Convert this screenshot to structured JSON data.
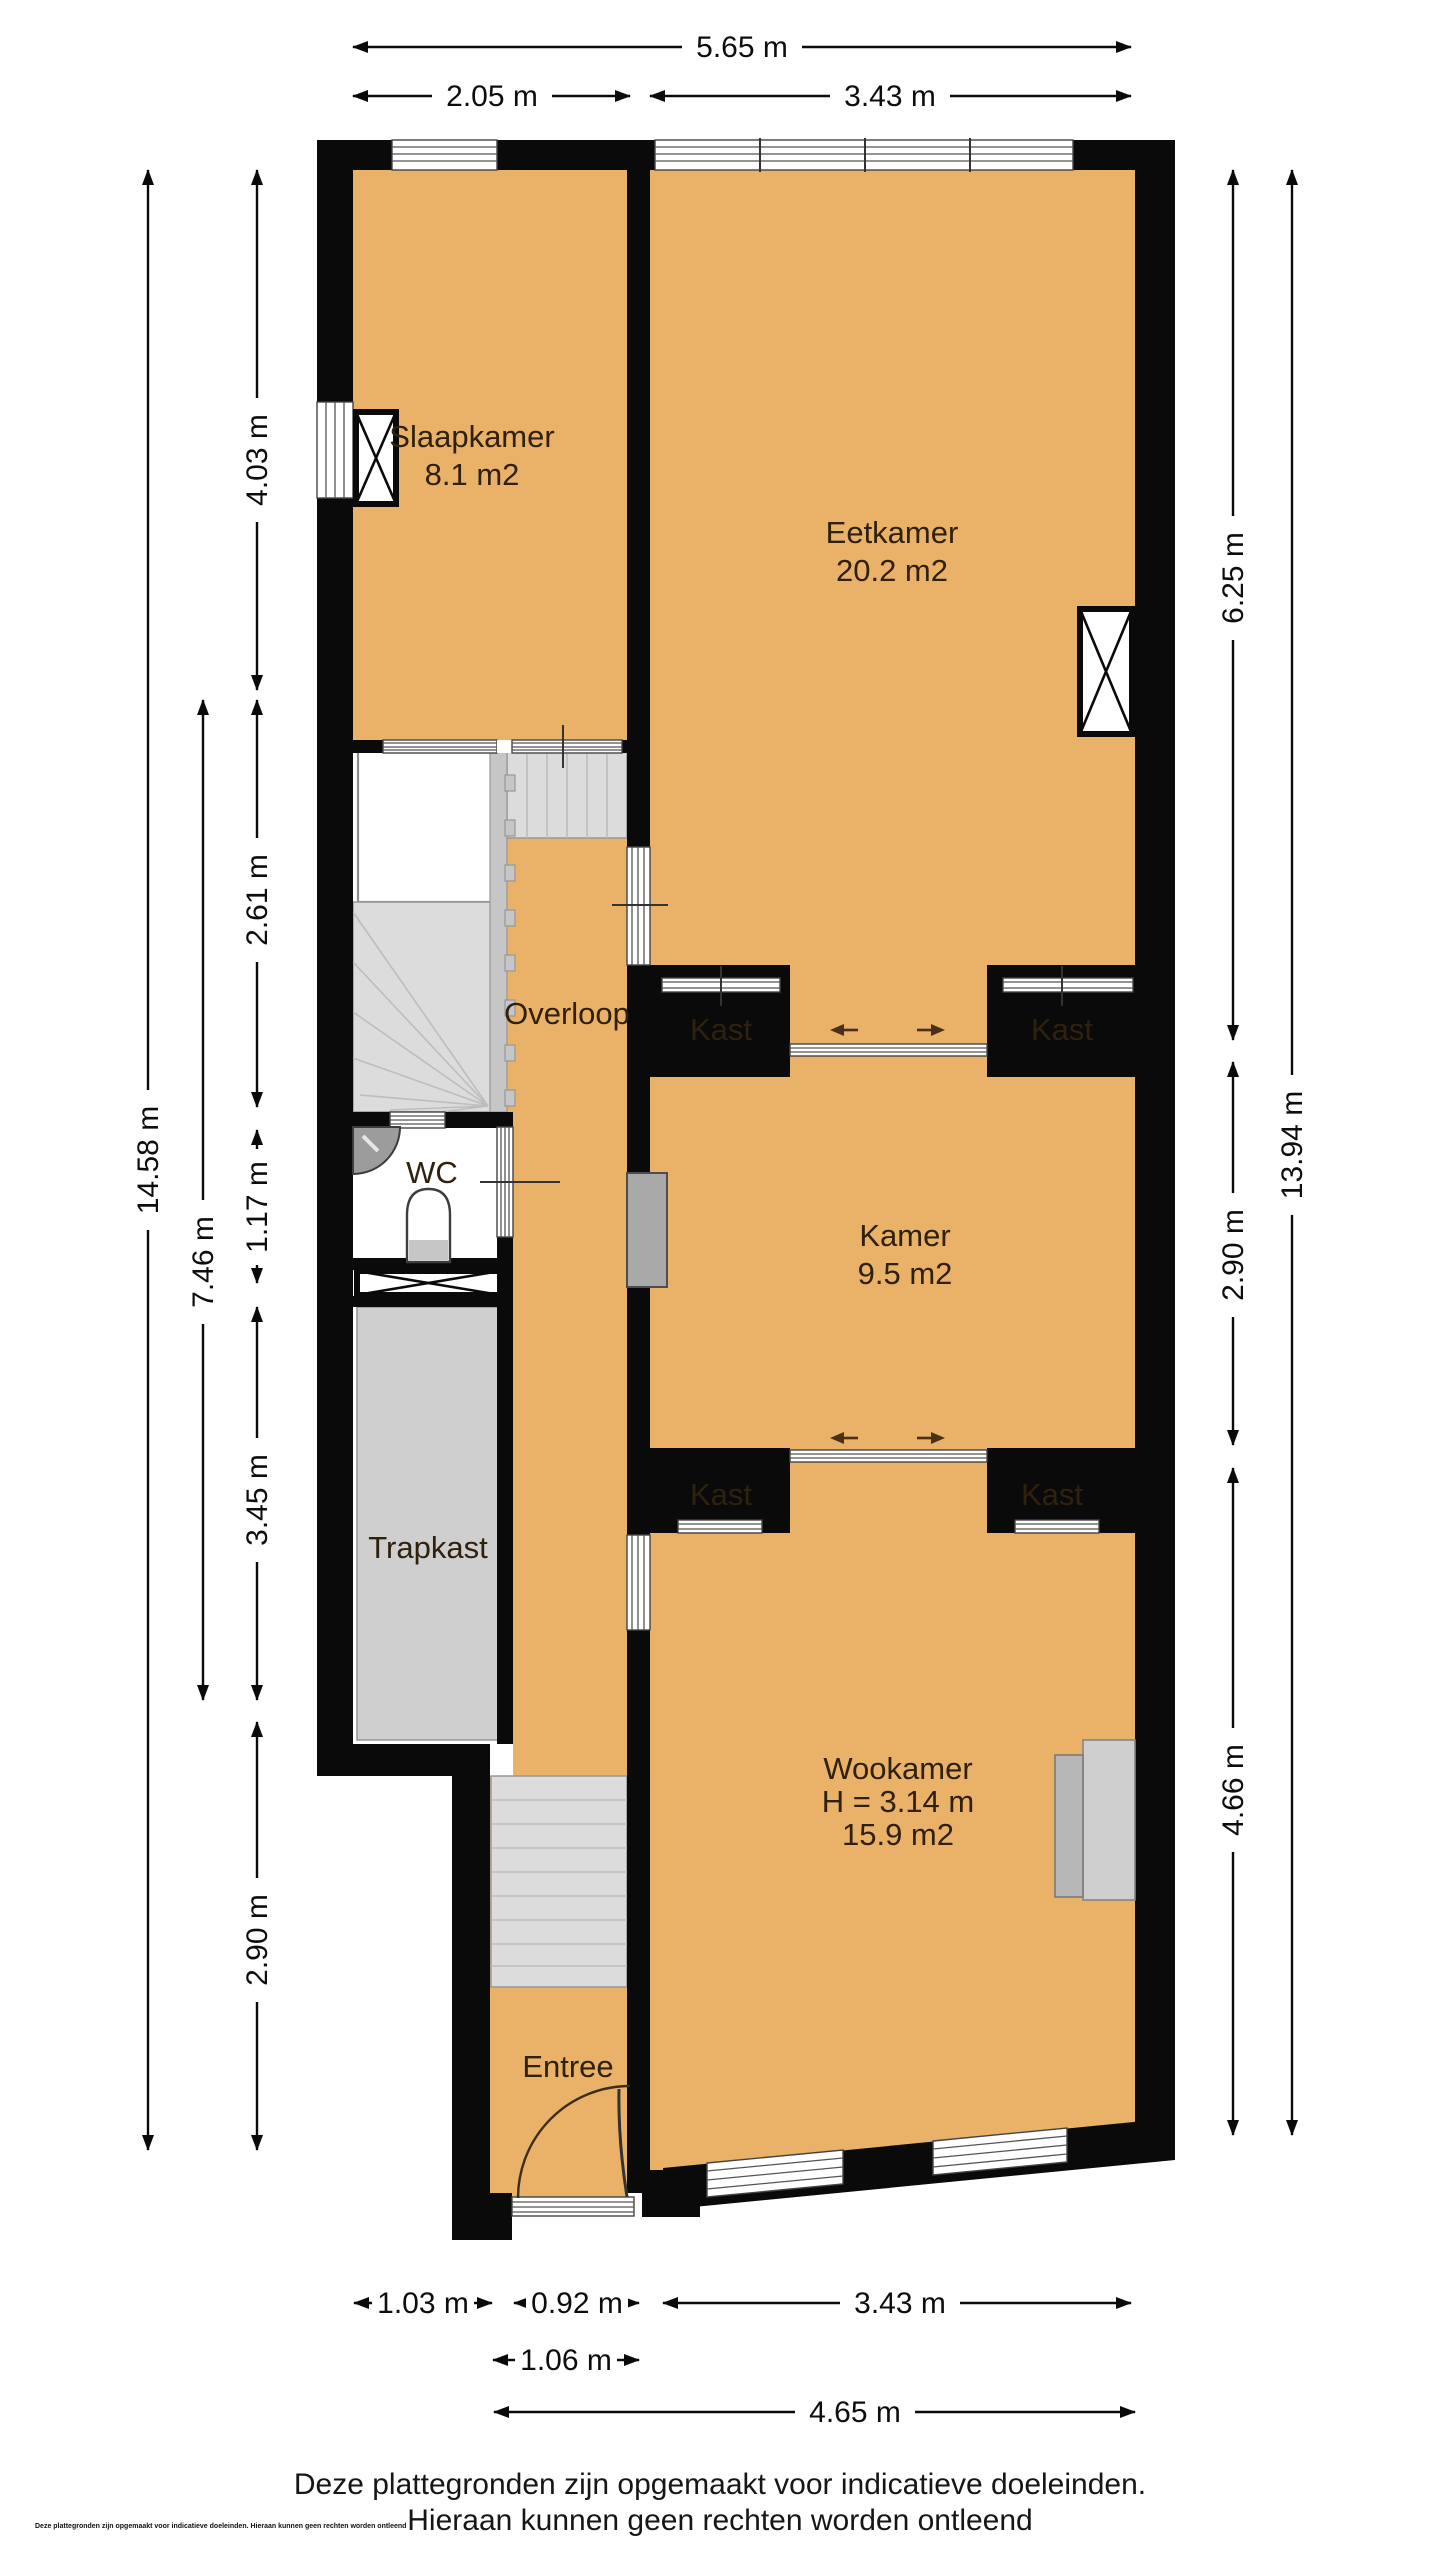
{
  "page": {
    "background": "#ffffff"
  },
  "colors": {
    "floor": "#e9b268",
    "wall": "#0a0a0a",
    "stairs": "#dcdcdc",
    "closet_fill": "#cbcbcb",
    "fixture_gray": "#9c9c9c",
    "room_text": "#30200e"
  },
  "rooms": {
    "slaapkamer": {
      "name": "Slaapkamer",
      "area": "8.1 m2"
    },
    "eetkamer": {
      "name": "Eetkamer",
      "area": "20.2 m2"
    },
    "overloop": {
      "name": "Overloop"
    },
    "wc": {
      "name": "WC"
    },
    "kast": {
      "name": "Kast"
    },
    "kamer": {
      "name": "Kamer",
      "area": "9.5 m2"
    },
    "trapkast": {
      "name": "Trapkast"
    },
    "wookamer": {
      "name": "Wookamer",
      "height": "H = 3.14 m",
      "area": "15.9 m2"
    },
    "entree": {
      "name": "Entree"
    }
  },
  "dimensions": {
    "top_total": "5.65 m",
    "top_left": "2.05 m",
    "top_right": "3.43 m",
    "left_total": "14.58 m",
    "left_mid": "7.46 m",
    "left_seg1": "4.03 m",
    "left_seg2": "2.61 m",
    "left_seg3": "1.17 m",
    "left_seg4": "3.45 m",
    "left_seg5": "2.90 m",
    "right_total": "13.94 m",
    "right_seg1": "6.25 m",
    "right_seg2": "2.90 m",
    "right_seg3": "4.66 m",
    "bottom_seg1": "1.03 m",
    "bottom_seg2": "0.92 m",
    "bottom_seg3": "3.43 m",
    "bottom_row2": "1.06 m",
    "bottom_row3": "4.65 m"
  },
  "footer": {
    "disclaimer_line1": "Deze plattegronden zijn opgemaakt voor indicatieve doeleinden.",
    "disclaimer_line2": "Hieraan kunnen geen rechten worden ontleend",
    "fine_print": "Deze plattegronden zijn opgemaakt voor indicatieve doeleinden. Hieraan kunnen geen rechten worden ontleend"
  }
}
